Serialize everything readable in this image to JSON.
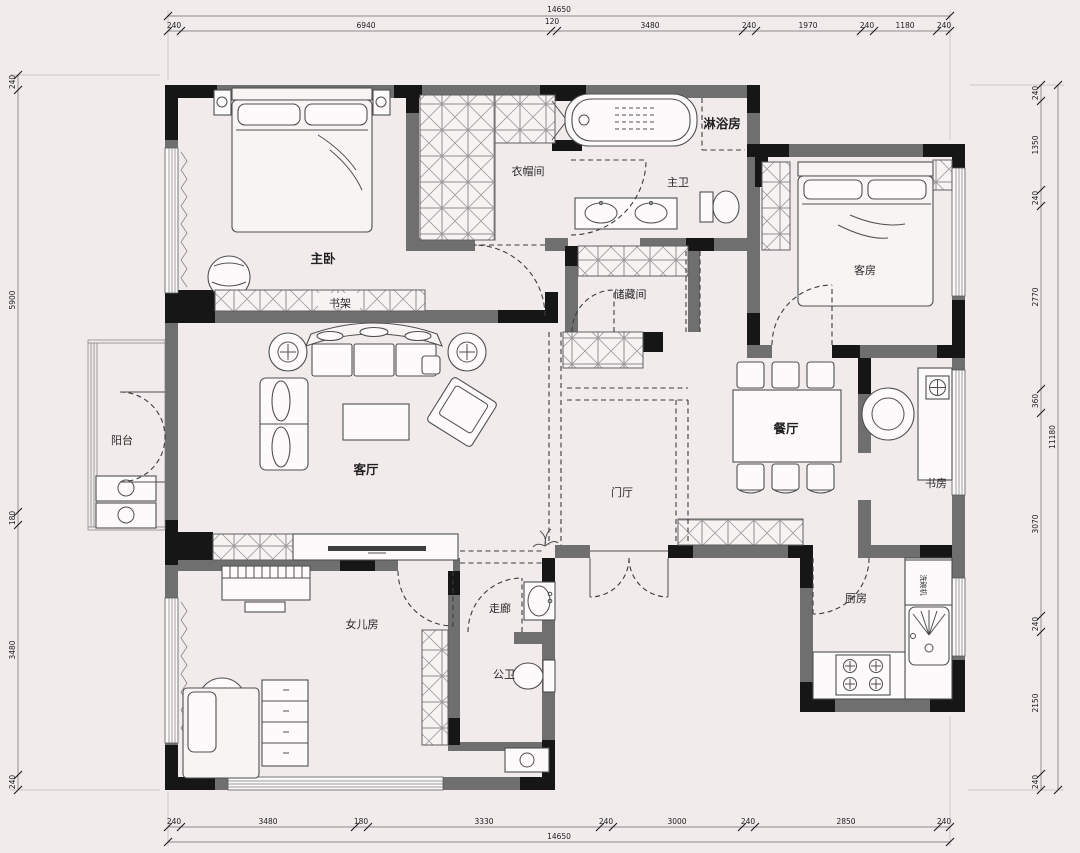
{
  "drawing": {
    "type": "apartment-floor-plan",
    "rooms": [
      {
        "id": "master-bedroom",
        "label": "主卧"
      },
      {
        "id": "cloakroom",
        "label": "衣帽间"
      },
      {
        "id": "shower-room",
        "label": "淋浴房"
      },
      {
        "id": "master-bath",
        "label": "主卫"
      },
      {
        "id": "storage-room",
        "label": "储藏间"
      },
      {
        "id": "guest-room",
        "label": "客房"
      },
      {
        "id": "dining-room",
        "label": "餐厅"
      },
      {
        "id": "study",
        "label": "书房"
      },
      {
        "id": "balcony",
        "label": "阳台"
      },
      {
        "id": "living-room",
        "label": "客厅"
      },
      {
        "id": "foyer",
        "label": "门厅"
      },
      {
        "id": "corridor",
        "label": "走廊"
      },
      {
        "id": "public-bath",
        "label": "公卫"
      },
      {
        "id": "daughters-room",
        "label": "女儿房"
      },
      {
        "id": "kitchen",
        "label": "厨房"
      }
    ],
    "fixtures": [
      {
        "id": "bookshelf",
        "label": "书架"
      },
      {
        "id": "dishwasher",
        "label": "洗碗机"
      }
    ],
    "dimensions": {
      "top": {
        "total": "14650",
        "segments": [
          "240",
          "6940",
          "120",
          "3480",
          "240",
          "1970",
          "240",
          "1180",
          "240"
        ]
      },
      "bottom": {
        "total": "14650",
        "segments": [
          "240",
          "3480",
          "180",
          "3330",
          "240",
          "3000",
          "240",
          "2850",
          "240"
        ]
      },
      "left": {
        "segments": [
          "240",
          "5900",
          "180",
          "3480",
          "240"
        ]
      },
      "right": {
        "total": "11180",
        "segments": [
          "240",
          "1350",
          "240",
          "2770",
          "360",
          "3070",
          "240",
          "2150",
          "240"
        ]
      }
    },
    "colors": {
      "background": "#f2ebec",
      "wall": "#6f6f6f",
      "column": "#161616",
      "furniture_line": "#4f4f4f",
      "dashed_line": "#3c3c3c",
      "dimension_text": "#1c1c1c"
    }
  }
}
